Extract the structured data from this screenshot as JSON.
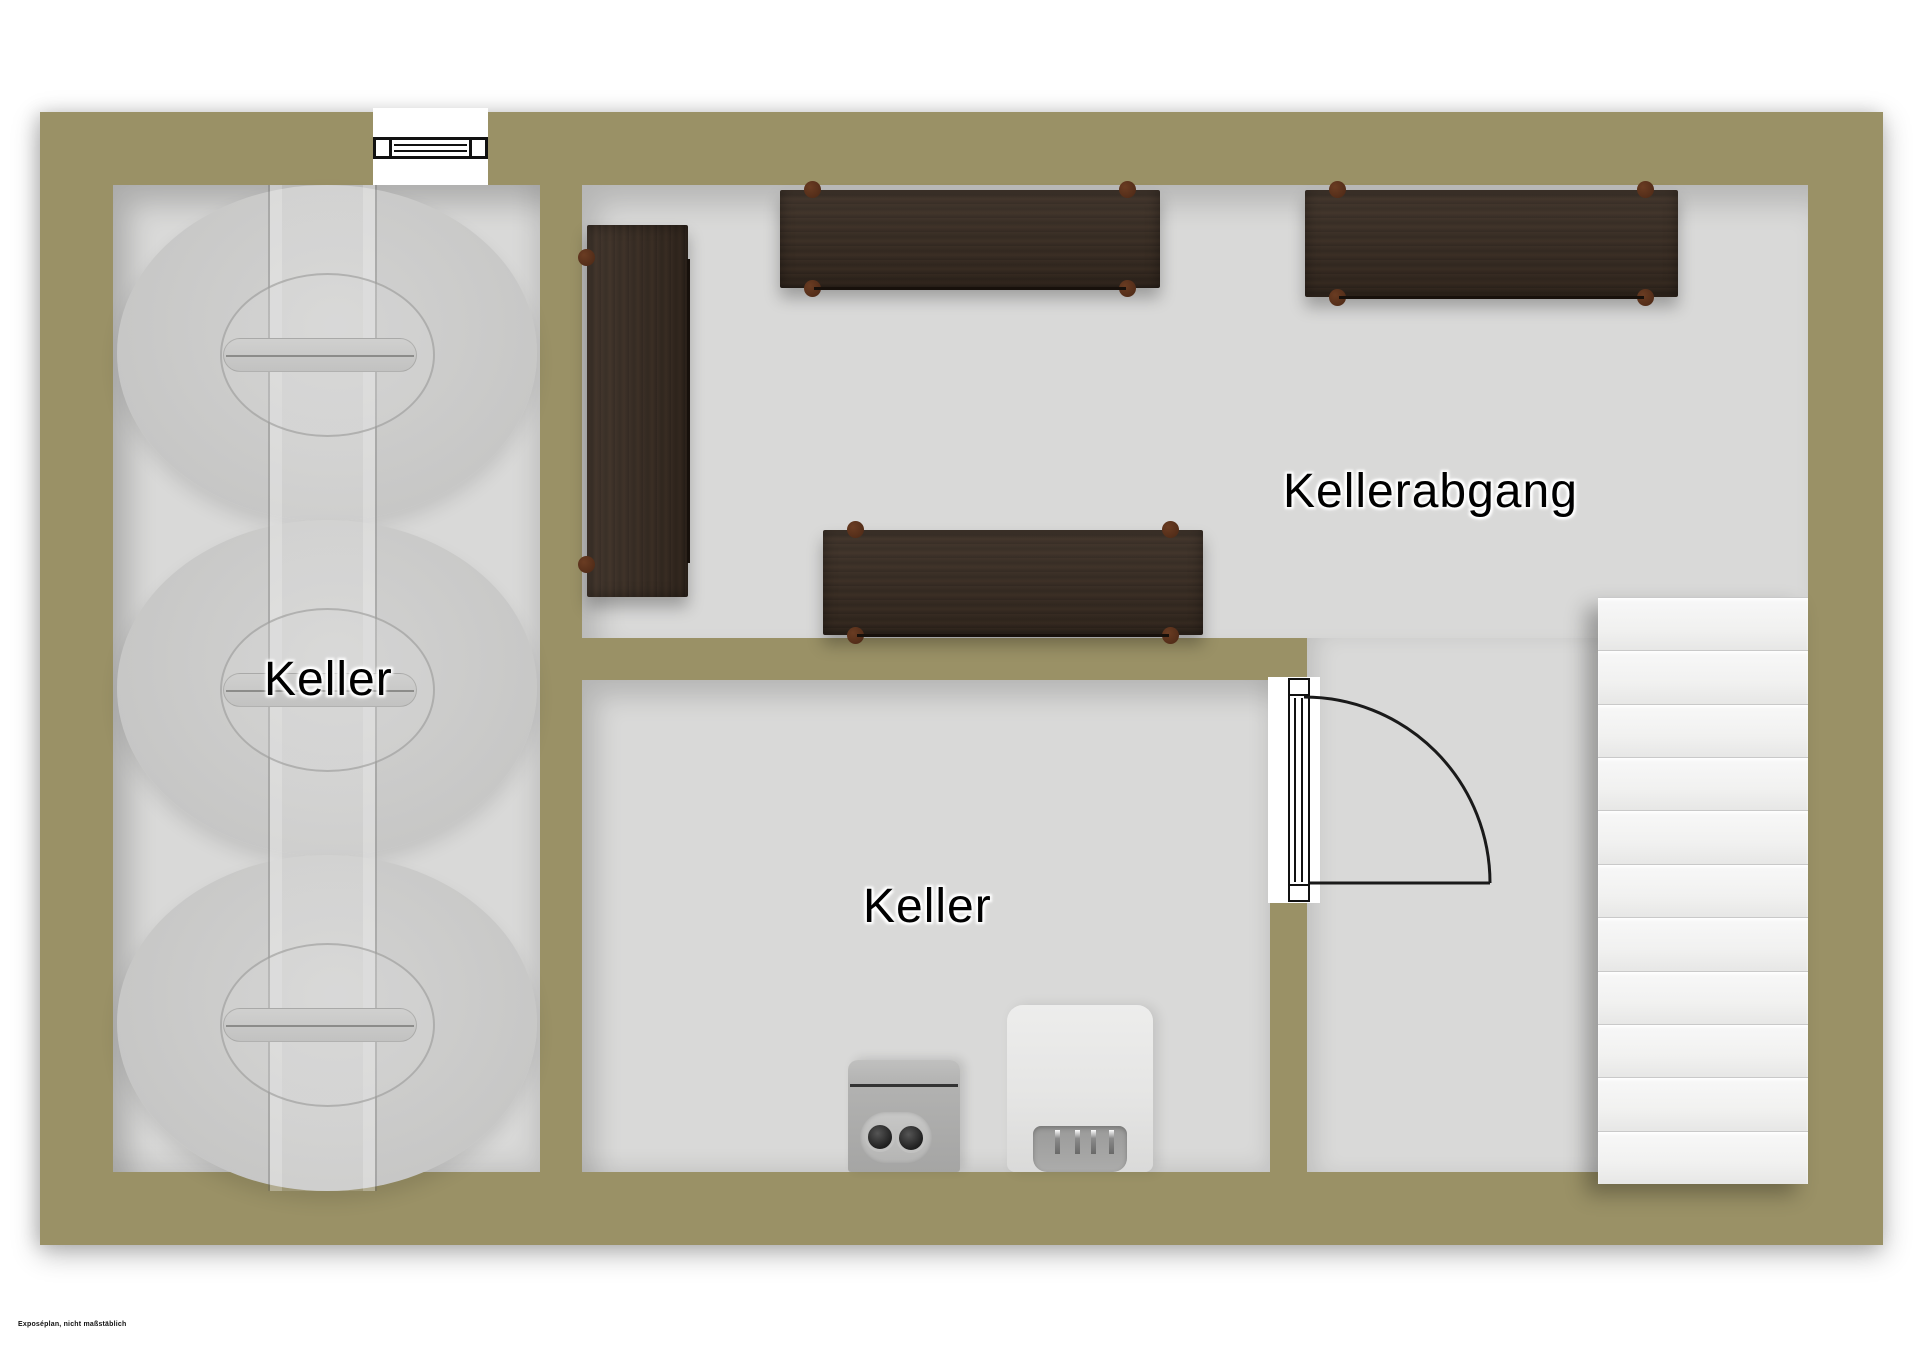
{
  "plan": {
    "title": "Kellergeschoss Grundriss",
    "footnote": "Exposéplan, nicht maßstäblich",
    "rooms": {
      "left": {
        "label": "Keller"
      },
      "bottom": {
        "label": "Keller"
      },
      "stair_room": {
        "label": "Kellerabgang"
      }
    },
    "objects": {
      "tanks": 3,
      "shelves": 4,
      "stair_steps": 11,
      "window_symbols": 1,
      "door_symbols": 1,
      "appliances": [
        "heating-unit",
        "boiler"
      ]
    },
    "colors": {
      "wall": "#9a9166",
      "floor": "#d9d9d8",
      "shelf_wood": "#35291f",
      "shelf_feet": "#5a331d",
      "stairs": "#f0f0f0",
      "tank": "#c9c9c8",
      "line": "#111111",
      "background": "#ffffff"
    }
  }
}
